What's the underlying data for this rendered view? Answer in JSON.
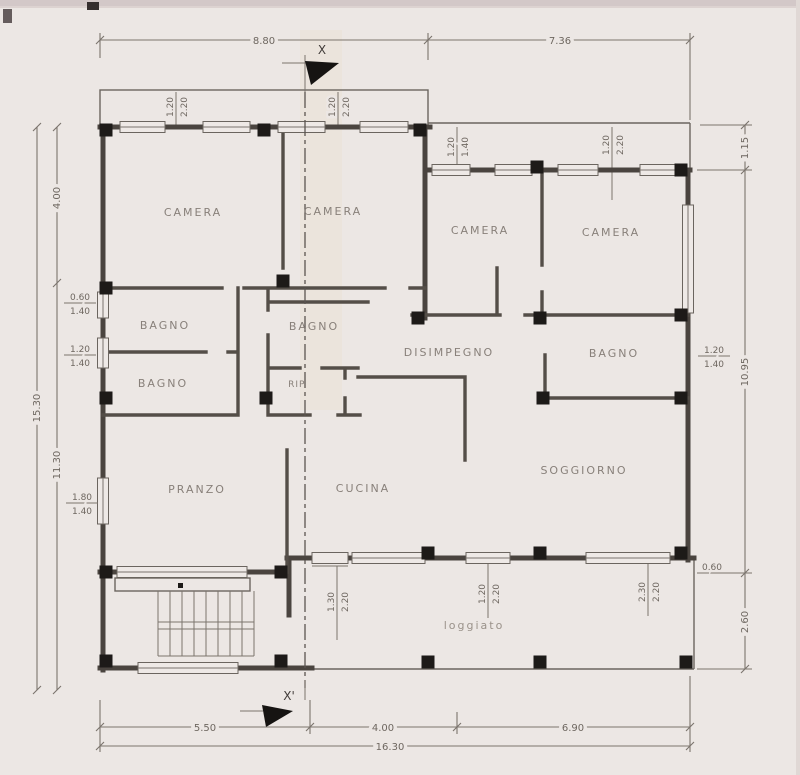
{
  "palette": {
    "paper": "#ece7e4",
    "paper_band": "#d3c8c8",
    "wall_line": "#4a443f",
    "column_black": "#1d1a18",
    "annotation_text": "#6e6760",
    "room_text": "#88807a"
  },
  "rooms": {
    "camera_nw": "CAMERA",
    "camera_n": "CAMERA",
    "camera_ne_left": "CAMERA",
    "camera_ne_right": "CAMERA",
    "bagno_w_upper": "BAGNO",
    "bagno_w_lower": "BAGNO",
    "bagno_mid": "BAGNO",
    "rip": "RIP.",
    "disimpegno": "DISIMPEGNO",
    "bagno_e": "BAGNO",
    "pranzo": "PRANZO",
    "cucina": "CUCINA",
    "soggiorno": "SOGGIORNO",
    "loggiato": "loggiato"
  },
  "sections": {
    "top": "X",
    "bottom": "X'"
  },
  "dims": {
    "top_left": "8.80",
    "top_right": "7.36",
    "left_upper": "4.00",
    "left_lower": "11.30",
    "left_total": "15.30",
    "right_top": "1.15",
    "right_main": "10.95",
    "right_loggia_width": "0.60",
    "right_loggia_height": "2.60",
    "bottom_left": "5.50",
    "bottom_mid": "4.00",
    "bottom_right": "6.90",
    "bottom_total": "16.30"
  },
  "openings": {
    "balcony_w1": {
      "w": "1.20",
      "h": "2.20"
    },
    "balcony_w2": {
      "w": "1.20",
      "h": "2.20"
    },
    "terrace_e1": {
      "w": "1.20",
      "h": "1.40"
    },
    "terrace_e2": {
      "w": "1.20",
      "h": "2.20"
    },
    "left_w1": {
      "w": "0.60",
      "h": "1.40"
    },
    "left_w2": {
      "w": "1.20",
      "h": "1.40"
    },
    "left_w3": {
      "w": "1.80",
      "h": "1.40"
    },
    "right_w1": {
      "w": "1.20",
      "h": "1.40"
    },
    "entry_door": {
      "w": "1.30",
      "h": "2.20"
    },
    "south_w1": {
      "w": "1.20",
      "h": "2.20"
    },
    "south_w2": {
      "w": "2.30",
      "h": "2.20"
    }
  }
}
